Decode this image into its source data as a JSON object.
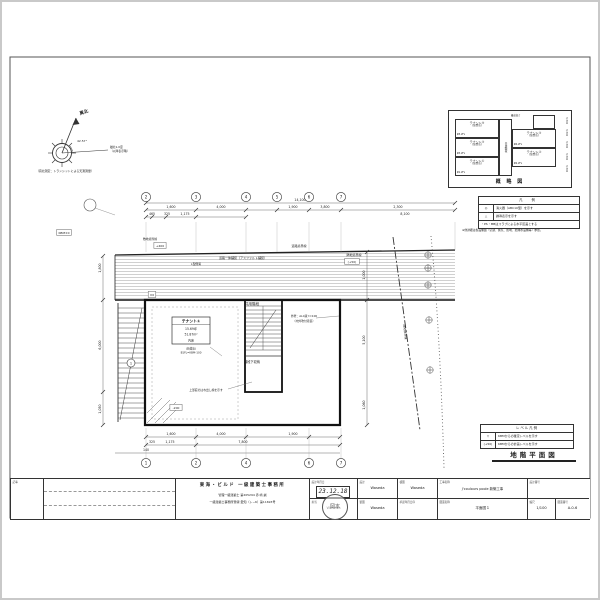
{
  "compass": {
    "north_label": "真北",
    "angle": "42.57°",
    "note1": "磁北1.0度",
    "note2": "（以降表示略）",
    "survey_note": "（真北測定：トランシットによる天測測量）"
  },
  "schematic": {
    "title": "概 略 図",
    "top_label": "最高高さ",
    "stair_label": "共用階段",
    "left_units": [
      {
        "name": "テナント⑤",
        "sub": "(飲食店)",
        "level": "▼5.2FL"
      },
      {
        "name": "テナント③",
        "sub": "(飲食店)",
        "level": "▼3.2FL"
      },
      {
        "name": "テナント①",
        "sub": "(飲食店)",
        "level": "▼1.2FL"
      }
    ],
    "right_units": [
      {
        "name": "テナント④",
        "sub": "(飲食店)",
        "level": "▼4.2FL"
      },
      {
        "name": "テナント②",
        "sub": "(飲食店)",
        "level": "▼2.2FL"
      }
    ],
    "dims": [
      "3,300",
      "3,300",
      "3,300",
      "3,300",
      "3,300"
    ]
  },
  "legend": {
    "title": "凡 例",
    "rows": [
      {
        "symbol": "◎",
        "text": "消火器（ABC10型）を示す"
      },
      {
        "symbol": "△",
        "text": "誘導表示を示す"
      }
    ],
    "footer": "・PS・MBはスラブによる水平区画とする",
    "note": "※他詳細は各設備図（空調、換気、照明、給排水設備等）参照。"
  },
  "level_legend": {
    "title": "レベル凡例",
    "rows": [
      {
        "symbol": "▽",
        "text": "KBMからの確定レベルを示す"
      },
      {
        "symbol": "(+50)",
        "text": "KBMからの計画レベルを示す"
      }
    ]
  },
  "plan_title": "地階平面図",
  "plan": {
    "tenant_box": {
      "name": "テナント①",
      "area_tsubo": "15.69坪",
      "area_m2": "51.87m²",
      "floor": "内床",
      "sub1": "(新貸床)",
      "sub2": "B1FL=KBM-100"
    },
    "stair_number": "1",
    "grid_top": [
      {
        "x": 146,
        "label": "2"
      },
      {
        "x": 196,
        "label": "3"
      },
      {
        "x": 246,
        "label": "4"
      },
      {
        "x": 277,
        "label": "5"
      },
      {
        "x": 309,
        "label": "6"
      },
      {
        "x": 341,
        "label": "7"
      }
    ],
    "grid_bottom": [
      {
        "x": 146,
        "label": "1"
      },
      {
        "x": 196,
        "label": "2"
      },
      {
        "x": 246,
        "label": "4"
      },
      {
        "x": 309,
        "label": "6"
      },
      {
        "x": 341,
        "label": "7"
      }
    ],
    "dim_labels": [
      {
        "x": 300,
        "y": 201,
        "t": "14,100"
      },
      {
        "x": 171,
        "y": 208,
        "t": "1,600"
      },
      {
        "x": 221,
        "y": 208,
        "t": "4,000"
      },
      {
        "x": 293,
        "y": 208,
        "t": "1,900"
      },
      {
        "x": 325,
        "y": 208,
        "t": "3,800"
      },
      {
        "x": 398,
        "y": 208,
        "t": "2,300"
      },
      {
        "x": 152,
        "y": 215,
        "t": "465"
      },
      {
        "x": 167,
        "y": 215,
        "t": "325"
      },
      {
        "x": 185,
        "y": 215,
        "t": "1,175"
      },
      {
        "x": 405,
        "y": 215,
        "t": "8,100"
      },
      {
        "x": 171,
        "y": 435,
        "t": "1,600"
      },
      {
        "x": 221,
        "y": 435,
        "t": "4,000"
      },
      {
        "x": 293,
        "y": 435,
        "t": "1,900"
      },
      {
        "x": 152,
        "y": 443,
        "t": "325"
      },
      {
        "x": 170,
        "y": 443,
        "t": "1,175"
      },
      {
        "x": 243,
        "y": 443,
        "t": "7,800"
      },
      {
        "x": 146,
        "y": 451,
        "t": "140"
      },
      {
        "x": 101,
        "y": 268,
        "t": "1,800",
        "rot": -90
      },
      {
        "x": 101,
        "y": 345,
        "t": "6,000",
        "rot": -90
      },
      {
        "x": 101,
        "y": 409,
        "t": "1,050",
        "rot": -90
      },
      {
        "x": 365,
        "y": 275,
        "t": "1,000",
        "rot": -90
      },
      {
        "x": 365,
        "y": 340,
        "t": "5,100",
        "rot": -90
      },
      {
        "x": 365,
        "y": 405,
        "t": "1,060",
        "rot": -90
      }
    ],
    "annotations": [
      {
        "x": 252,
        "y": 305,
        "t": "共用階段",
        "fs": 3.6
      },
      {
        "x": 252,
        "y": 363,
        "t": "階段下収納",
        "fs": 3.2
      },
      {
        "x": 243,
        "y": 259,
        "t": "道路一体舗装（アスファルト舗装）",
        "fs": 3
      },
      {
        "x": 196,
        "y": 265,
        "t": "L型側溝",
        "fs": 2.8
      },
      {
        "x": 299,
        "y": 247,
        "t": "道路境界線",
        "fs": 3
      },
      {
        "x": 354,
        "y": 256,
        "t": "隣地境界線",
        "fs": 3
      },
      {
        "x": 304,
        "y": 317,
        "t": "外壁：ALC版 t=100",
        "fs": 2.8
      },
      {
        "x": 304,
        "y": 322,
        "t": "（内外吹付塗装）",
        "fs": 2.8
      },
      {
        "x": 206,
        "y": 391,
        "t": "上部庇のはね出し線を示す",
        "fs": 2.8
      },
      {
        "x": 404,
        "y": 332,
        "t": "隣地境界線",
        "fs": 3,
        "rot": 83
      },
      {
        "x": 150,
        "y": 240,
        "t": "敷地境界線",
        "fs": 2.8
      }
    ],
    "level_tags": [
      {
        "x": 160,
        "y": 247,
        "t": "+400"
      },
      {
        "x": 152,
        "y": 296,
        "t": "±0"
      },
      {
        "x": 176,
        "y": 409,
        "t": "-200"
      },
      {
        "x": 352,
        "y": 263,
        "t": "(+50)"
      },
      {
        "x": 64,
        "y": 234,
        "t": "KBM±0"
      }
    ]
  },
  "title_block": {
    "notes_label": "記事",
    "firm": {
      "name": "東海・ビルド 一級建築士事務所",
      "reg1": "管理一級建築士 第205294 赤 崎 誠",
      "reg2": "一級建築士事務所登録 愛知（レ−6）第11693号"
    },
    "stamp": {
      "date": "23.12.18",
      "seal": "岡本"
    },
    "design_date_label": "設計年月日",
    "design_date": "2023.06.29",
    "tanto_label": "担当",
    "tanto": "Waseda",
    "sekkei_label": "設計",
    "sekkei": "Waseda",
    "seizu_label": "製図",
    "seizu": "Waseda",
    "kenzu_label": "検図",
    "kenzu": "Waseda",
    "approval_label": "承認年月日印",
    "project_label": "工事名称",
    "project": "J'coulours poole 新築工事",
    "drawing_label": "図面名称",
    "drawing": "平面図１",
    "scale_label": "縮尺",
    "scale": "1/100",
    "design_no_label": "設計番号",
    "drawing_no_label": "図面番号",
    "drawing_no": "A-0-6"
  }
}
